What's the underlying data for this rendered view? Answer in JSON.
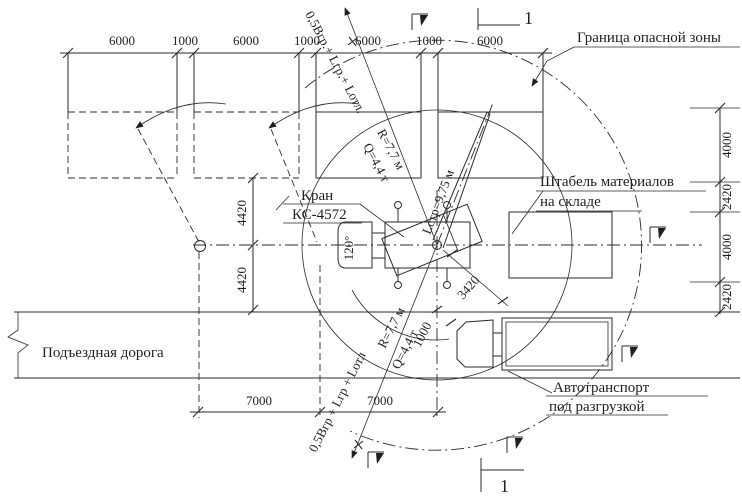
{
  "labels": {
    "boundary": "Граница опасной зоны",
    "stack1": "Штабель материалов",
    "stack2": "на складе",
    "crane1": "Кран",
    "crane2": "КС-4572",
    "road": "Подъездная дорога",
    "truck1": "Автотранспорт",
    "truck2": "под разгрузкой",
    "formula_top": "0,5Вгр.+ Lгр.+ Lотл.",
    "formula_bottom": "0,5Вгр + Lгр + Lотл",
    "r_top": "R=7,7 м",
    "q_top": "Q=4,4 т",
    "r_bottom": "R=7,7 м",
    "q_bottom": "Q=4,4 т",
    "boom": "Lстр=9,75 м",
    "angle": "120°",
    "sec_top": "1",
    "sec_bottom": "1"
  },
  "dims": {
    "top": [
      "6000",
      "1000",
      "6000",
      "1000",
      "6000",
      "1000",
      "6000"
    ],
    "right": [
      "4000",
      "2420",
      "4000",
      "2420"
    ],
    "left": [
      "4420",
      "4420"
    ],
    "bottom": [
      "7000",
      "7000"
    ],
    "diag": "3420",
    "offset": "1000"
  },
  "colors": {
    "ink": "#1f1f1f",
    "paper": "#ffffff"
  }
}
